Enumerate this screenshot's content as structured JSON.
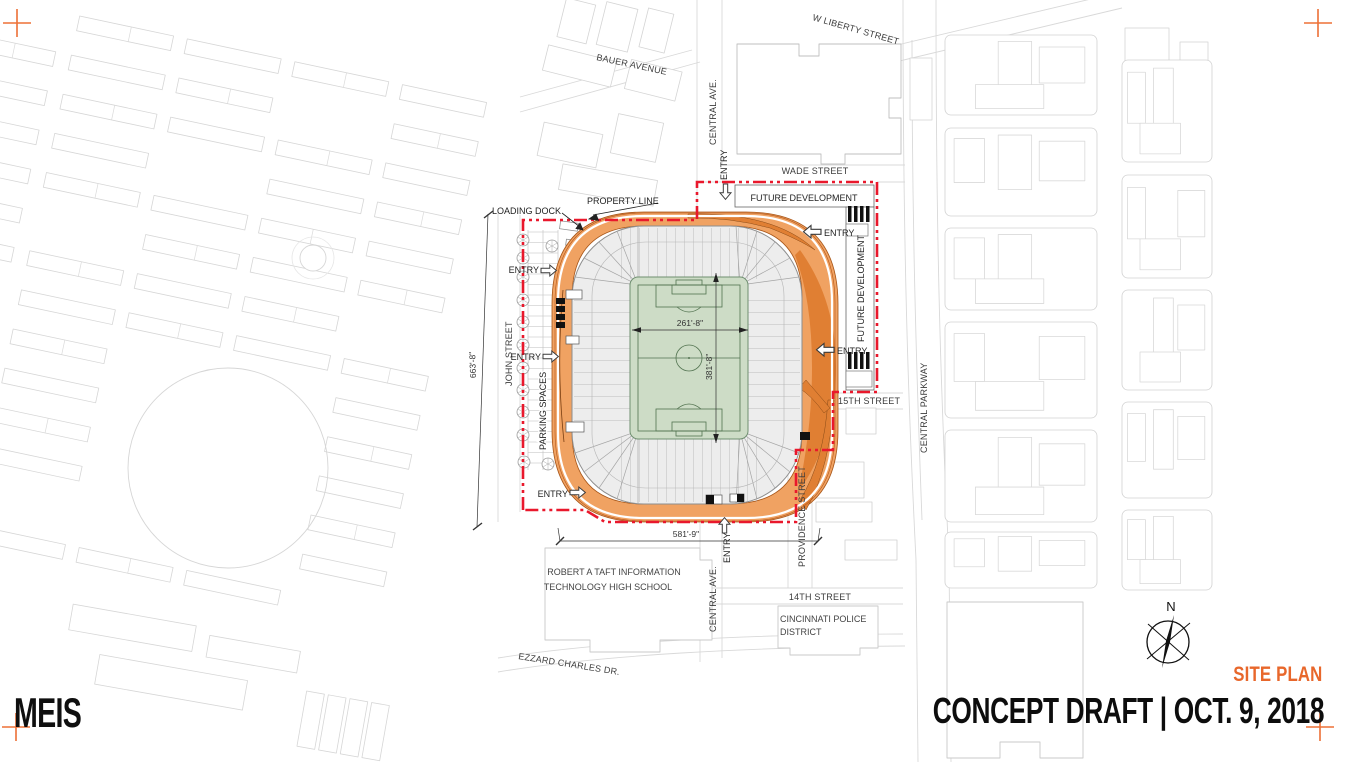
{
  "title_block": {
    "logo": "MEIS",
    "sheet_name": "SITE PLAN",
    "title": "CONCEPT DRAFT | OCT. 9, 2018"
  },
  "compass": {
    "north": "N"
  },
  "streets": {
    "w_liberty": "W LIBERTY STREET",
    "bauer": "BAUER AVENUE",
    "central_ave": "CENTRAL AVE.",
    "wade": "WADE STREET",
    "john": "JOHN STREET",
    "fifteenth": "15TH STREET",
    "fourteenth": "14TH STREET",
    "central_parkway": "CENTRAL PARKWAY",
    "providence": "PROVIDENCE STREET",
    "ezzard_charles": "EZZARD CHARLES DR."
  },
  "site_labels": {
    "property_line": "PROPERTY LINE",
    "loading_dock": "LOADING DOCK",
    "future_development": "FUTURE DEVELOPMENT",
    "parking_spaces": "PARKING SPACES",
    "entry": "ENTRY"
  },
  "landmarks": {
    "school_line1": "ROBERT A TAFT INFORMATION",
    "school_line2": "TECHNOLOGY HIGH SCHOOL",
    "police_line1": "CINCINNATI POLICE",
    "police_line2": "DISTRICT"
  },
  "dimensions": {
    "field_width": "261'-8\"",
    "field_length": "381'-8\"",
    "site_south": "581'-9\"",
    "site_west": "663'-8\""
  },
  "colors": {
    "accent_orange": "#E8672B",
    "roof_orange": "#F0A262",
    "roof_accent": "#E07F33",
    "property_red": "#E9182C",
    "field_green": "#CDDCC6"
  }
}
